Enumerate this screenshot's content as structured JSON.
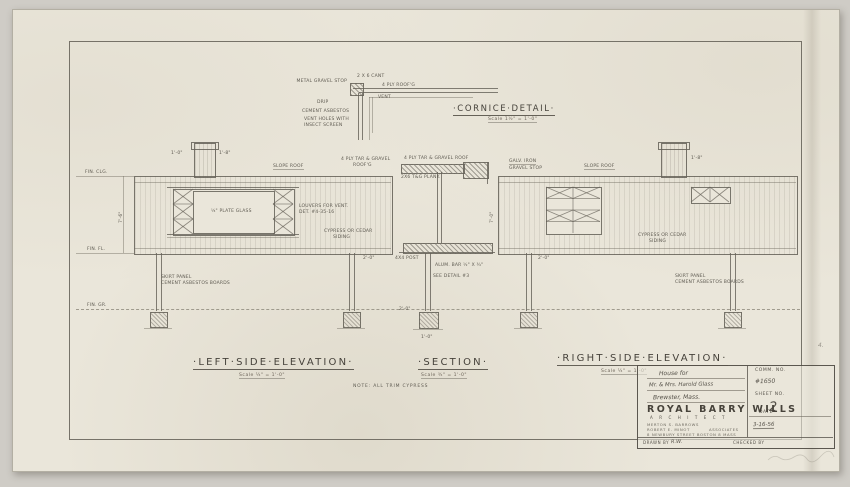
{
  "cornice": {
    "title": "·Cornice·Detail·",
    "scale": "Scale 1½\" = 1'-0\"",
    "labels": {
      "gravel_stop": "Metal Gravel Stop",
      "cant": "2 x 6 Cant",
      "roofing": "4 Ply Roof'g",
      "vent_top": "Vent",
      "drip": "Drip",
      "cement_asbestos": "Cement Asbestos",
      "vent_holes_1": "Vent holes with",
      "vent_holes_2": "insect screen"
    }
  },
  "left_elev": {
    "title": "·Left·Side·Elevation·",
    "scale": "Scale ¼\" = 1'-0\"",
    "labels": {
      "slope_roof": "Slope Roof",
      "roof_1": "4 Ply Tar & Gravel",
      "roof_2": "Roof'g",
      "plate_glass": "¼\" Plate Glass",
      "louvers_1": "Louvers for vent.",
      "louvers_2": "Det. #4-35-16",
      "siding_1": "Cypress or Cedar",
      "siding_2": "Siding",
      "skirt_1": "Skirt Panel",
      "skirt_2": "Cement Asbestos Boards",
      "fin_clg": "Fin. Clg.",
      "fin_fl": "Fin. Fl.",
      "fin_gr": "Fin. Gr.",
      "dim_left": "1'-0\"",
      "dim_right": "1'-8\"",
      "dim_height": "7'-6\"",
      "dim_post": "2'-0\""
    }
  },
  "section": {
    "title": "·Section·",
    "scale": "Scale ¾\" = 1'-0\"",
    "labels": {
      "roof": "4 Ply Tar & Gravel Roof",
      "plank": "2x6 T&G Plank",
      "post": "4x4 Post",
      "alum_bar": "Alum. bar ½\" x ¾\"",
      "see_detail": "See Detail #3",
      "dim_height": "7'-0\"",
      "dim_footing": "1'-0\"",
      "dim_post": "2'-0\""
    }
  },
  "right_elev": {
    "title": "·Right·Side·Elevation·",
    "scale": "Scale ¼\" = 1'-0\"",
    "labels": {
      "gravel_1": "Galv. Iron",
      "gravel_2": "Gravel Stop",
      "slope_roof": "Slope Roof",
      "siding_1": "Cypress or Cedar",
      "siding_2": "Siding",
      "skirt_1": "Skirt Panel",
      "skirt_2": "Cement Asbestos Boards",
      "dim_chimney": "1'-8\"",
      "dim_post": "2'-0\""
    }
  },
  "note": "Note: All Trim Cypress",
  "title_block": {
    "project_line": "House for",
    "client_line": "Mr. & Mrs. Harold Glass",
    "town_line": "Brewster, Mass.",
    "comm_label": "COMM. NO.",
    "comm_no": "#1650",
    "sheet_label": "SHEET NO.",
    "sheet_no": "2",
    "firm": "ROYAL BARRY WILLS",
    "firm_title": "A R C H I T E C T",
    "assoc_1": "MERTON S. BARROWS",
    "assoc_2": "ROBERT E. MINOT",
    "assoc_suffix": "ASSOCIATES",
    "address": "8 NEWBURY STREET BOSTON 8 MASS",
    "date_label": "DATE",
    "date": "3-16-56",
    "drawn_label": "DRAWN BY",
    "drawn_by": "R.W.",
    "checked_label": "CHECKED BY"
  },
  "margin_note": "4."
}
